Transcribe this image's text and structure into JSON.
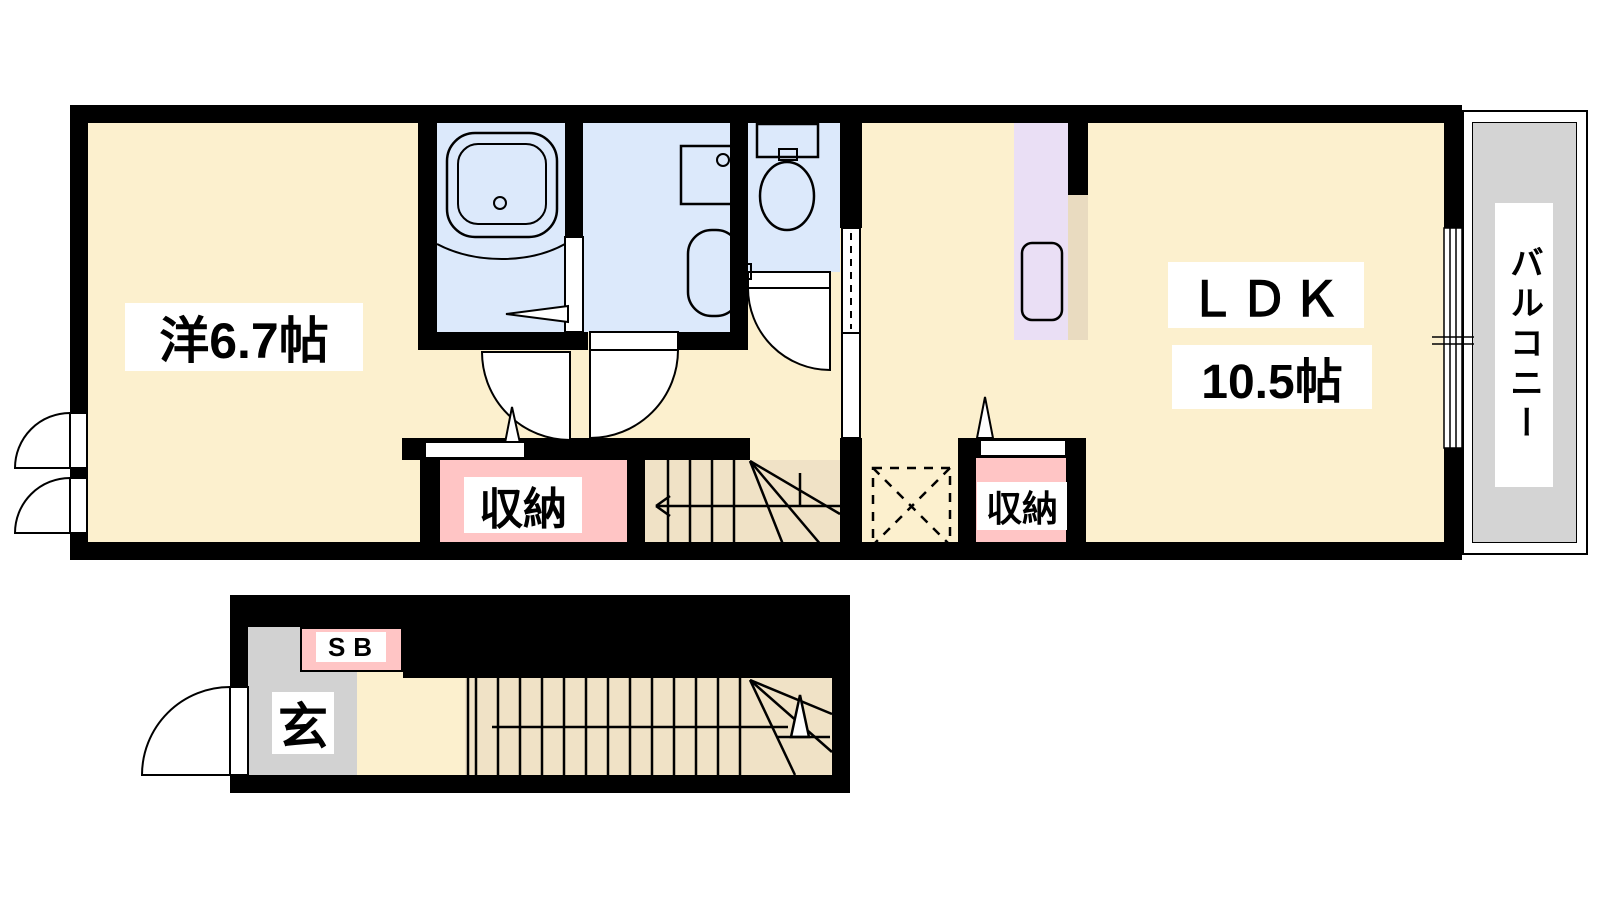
{
  "floorplan": {
    "title": "apartment floor plan",
    "rooms": {
      "western_room": {
        "label": "洋6.7帖"
      },
      "ldk": {
        "label": "ＬＤＫ",
        "area_label": "10.5帖"
      },
      "balcony": {
        "label": "バルコニー"
      },
      "storage_hall": {
        "label": "収納"
      },
      "storage_ldk": {
        "label": "収納"
      },
      "entrance": {
        "label": "玄"
      },
      "shoe_box": {
        "label": "SB"
      }
    },
    "fixtures": [
      "bathtub",
      "washing-machine-pan",
      "vanity-sink",
      "toilet",
      "kitchen-counter-sink",
      "refrigerator-space",
      "staircase-upper",
      "staircase-lower"
    ],
    "colors": {
      "floor_cream": "#FCF0CE",
      "wet_area_blue": "#DCE9FB",
      "storage_pink": "#FFC5C5",
      "kitchen_purple": "#EADFF5",
      "entrance_gray": "#D2D2D2",
      "balcony_gray": "#D4D4D4",
      "stair_tan": "#F0E2C6",
      "counter_tan": "#E9DBC0",
      "wall_black": "#000000"
    }
  }
}
